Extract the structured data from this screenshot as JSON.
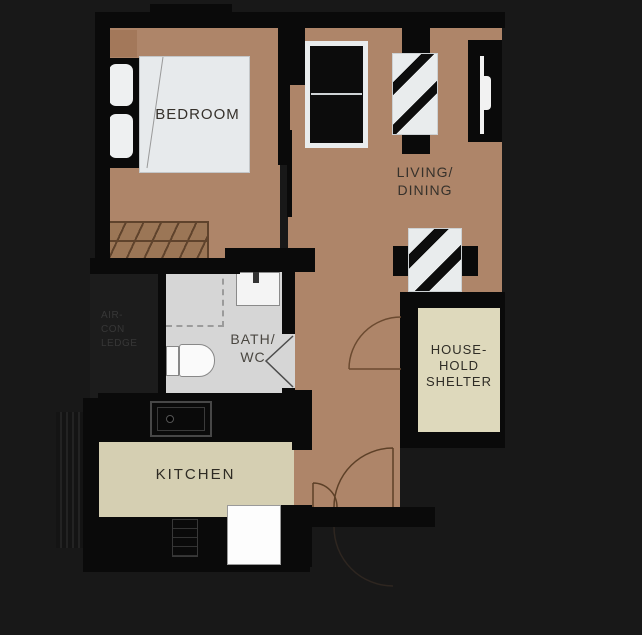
{
  "plan_title": "one-bedroom apartment floor plan",
  "rooms": {
    "bedroom": {
      "label": "BEDROOM"
    },
    "living_dining": {
      "label": "LIVING/\nDINING"
    },
    "bath_wc": {
      "label": "BATH/\nWC"
    },
    "kitchen": {
      "label": "KITCHEN"
    },
    "household_shelter": {
      "label": "HOUSE-\nHOLD\nSHELTER"
    },
    "aircon_ledge": {
      "label": "AIR-\nCON\nLEDGE"
    }
  },
  "icons": {
    "bed-icon": "double bed with fold line",
    "pillow-icon": "rounded pillow",
    "wardrobe-icon": "hatched wardrobe",
    "sofa-icon": "two-seat sofa",
    "tv-icon": "wall-mounted tv",
    "desk-icon": "striped table",
    "dining-table-icon": "striped table with chairs",
    "chair-icon": "black chair block",
    "bath-sink-icon": "basin with tap",
    "toilet-icon": "toilet tank and bowl",
    "shower-icon": "dashed shower zone",
    "kitchen-sink-icon": "counter sink outline",
    "stove-icon": "hob outline",
    "fridge-icon": "white appliance",
    "window-icon": "white window strip",
    "door-arc-icon": "door swing arc",
    "bifold-door-icon": "folding door chevron",
    "louver-icon": "ledge louvers"
  },
  "colors": {
    "background": "#181818",
    "wall": "#0a0a0a",
    "floor_wood": "#ae8569",
    "floor_bath": "#d6d6d6",
    "floor_kitchen": "#d5cfb2",
    "floor_shelter": "#ded9bc",
    "furniture_white": "#e9eced",
    "wardrobe_brown": "#9b7656",
    "door_arc": "#5d4027",
    "label_text": "#36312b"
  }
}
